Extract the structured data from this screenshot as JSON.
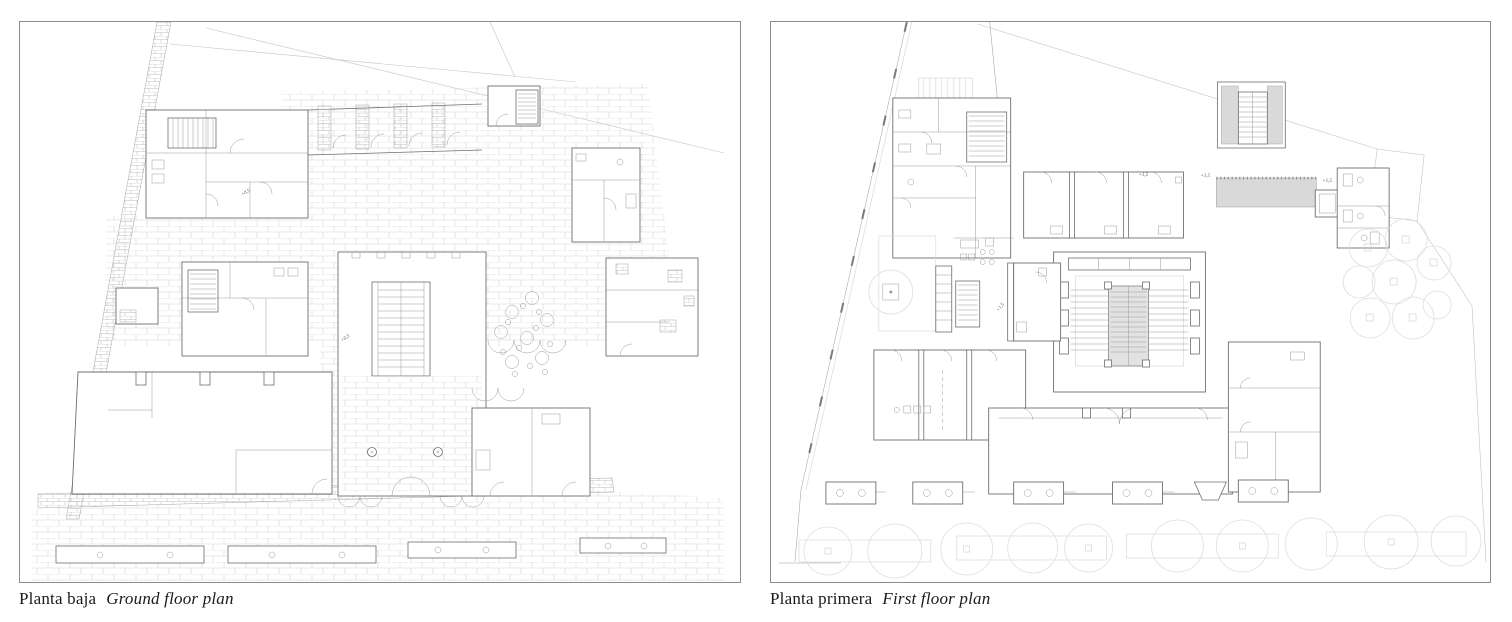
{
  "page": {
    "background": "#ffffff"
  },
  "panels": [
    {
      "id": "ground-floor",
      "caption_es": "Planta baja",
      "caption_en": "Ground floor plan",
      "labels": [
        {
          "text": "+0,5"
        },
        {
          "text": "+0,5"
        }
      ]
    },
    {
      "id": "first-floor",
      "caption_es": "Planta primera",
      "caption_en": "First floor plan",
      "labels": [
        {
          "text": "+1,5"
        },
        {
          "text": "+1,5"
        },
        {
          "text": "+1,5"
        },
        {
          "text": "+1,5"
        }
      ]
    }
  ],
  "colors": {
    "wall_line": "#6e6e6e",
    "thin_line": "#9a9a9a",
    "faint_line": "#c4c4c4",
    "paving_line": "#d4d4d4",
    "gray_fill": "#d9d9d9",
    "stair_fill": "#e2e2e2",
    "tree_line": "#dedede",
    "panel_border": "#8c8c8c",
    "caption_text": "#1a1a1a",
    "label_text": "#555555"
  }
}
